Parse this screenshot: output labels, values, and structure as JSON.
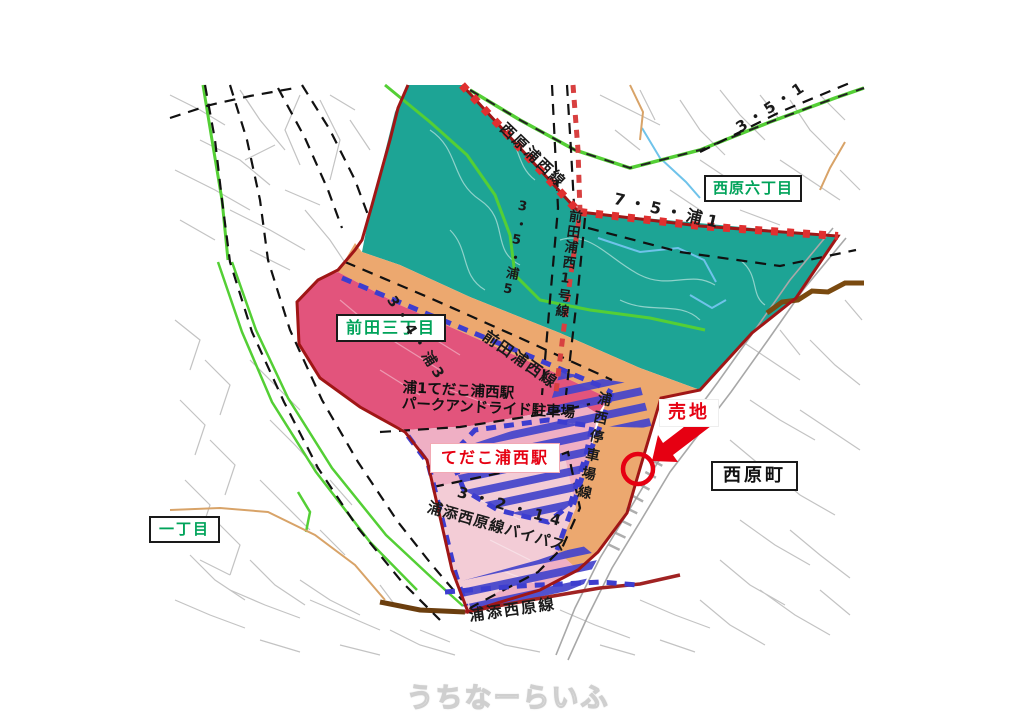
{
  "page": {
    "watermark": "うちなーらいふ"
  },
  "map": {
    "area_labels": {
      "nishihara_rokuchome": "西原六丁目",
      "maeda_sanchome": "前田三丁目",
      "itchome": "一丁目",
      "nishihara_cho": "西原町"
    },
    "station_labels": {
      "park_and_ride_line1": "浦1てだこ浦西駅",
      "park_and_ride_line2": "パークアンドライド駐車場",
      "tedako_urnishi_station": "てだこ浦西駅"
    },
    "sale_label": "売地",
    "road_labels": {
      "nishihara_urnishi_line": "西原浦西線",
      "route_3_5_1": "3・5・1",
      "route_7_5_ura1": "7・5・浦1",
      "route_3_5_ura5": "3・5・浦5",
      "maeda_urnishi_no1_line": "前田浦西1号線",
      "maeda_urnishi_line": "前田浦西線",
      "route_3_4_ura3": "3・4・浦3",
      "route_3_2_14": "3・2・14",
      "urasoe_nishihara_bypass": "浦添西原線バイパス",
      "urnishi_teishajo_line": "浦西停車場線",
      "urasoe_nishihara_line": "浦添西原線"
    },
    "colors": {
      "zone_teal": "#1da495",
      "zone_orange": "#eca86f",
      "zone_rose": "#e2547c",
      "zone_station_pink": "#efafc4",
      "zone_bypass_pink": "#f3ccd6",
      "boundary_red": "#a01616",
      "tie_red": "#e03030",
      "dash_blue": "#3d3dcf",
      "road_green": "#54cf35",
      "label_green": "#00a35a",
      "text_red": "#e60012",
      "boundary_brown": "#7a4a10"
    }
  }
}
